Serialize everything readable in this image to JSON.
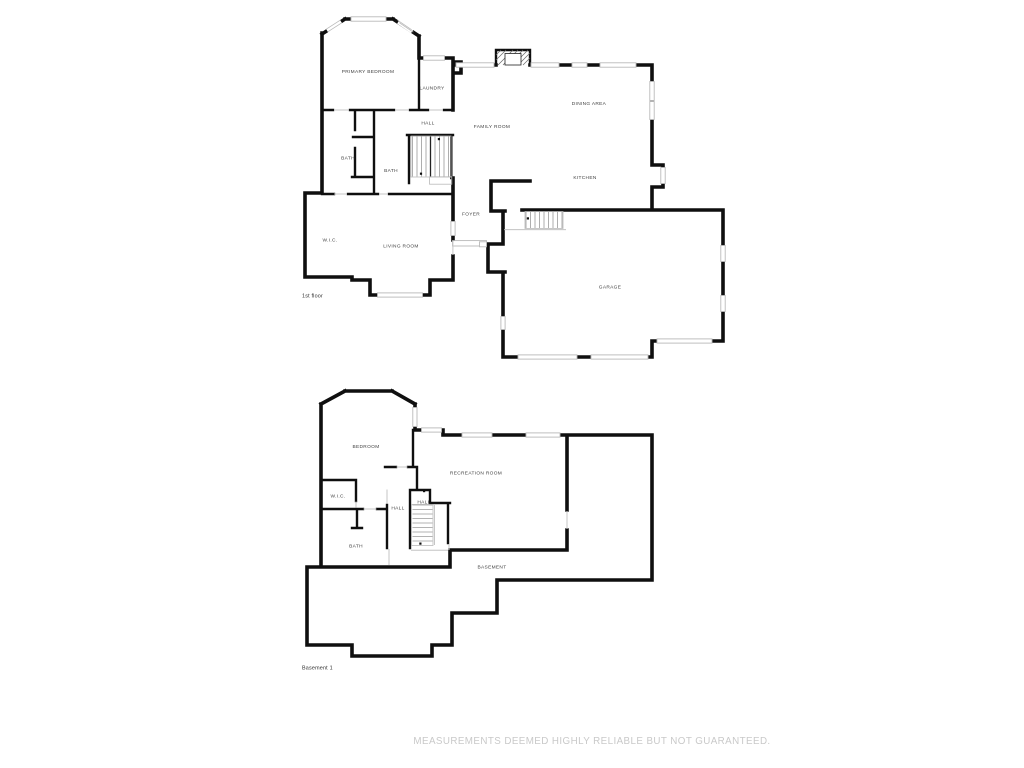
{
  "colors": {
    "background": "#ffffff",
    "wall": "#0f0f0f",
    "window_line": "#b9b9b9",
    "door_line": "#c6c6c6",
    "label_text": "#3f3f3f",
    "caption_text": "#2e2e2e",
    "footer_text": "#c9c9c9",
    "tread_line": "#9a9a9a"
  },
  "footer": {
    "disclaimer": "MEASUREMENTS DEEMED HIGHLY RELIABLE BUT NOT GUARANTEED."
  },
  "floor1": {
    "caption": "1st floor",
    "labels": {
      "primary_bedroom": "PRIMARY BEDROOM",
      "laundry": "LAUNDRY",
      "hall": "HALL",
      "bath_left": "BATH",
      "bath_center": "BATH",
      "family_room": "FAMILY ROOM",
      "dining_area": "DINING AREA",
      "kitchen": "KITCHEN",
      "foyer": "FOYER",
      "wic": "W.I.C.",
      "living_room": "LIVING ROOM",
      "garage": "GARAGE"
    }
  },
  "basement": {
    "caption": "Basement 1",
    "labels": {
      "bedroom": "BEDROOM",
      "recreation_room": "RECREATION ROOM",
      "wic": "W.I.C.",
      "hall_left": "HALL",
      "hall_right": "HALL",
      "bath": "BATH",
      "basement": "BASEMENT"
    }
  }
}
